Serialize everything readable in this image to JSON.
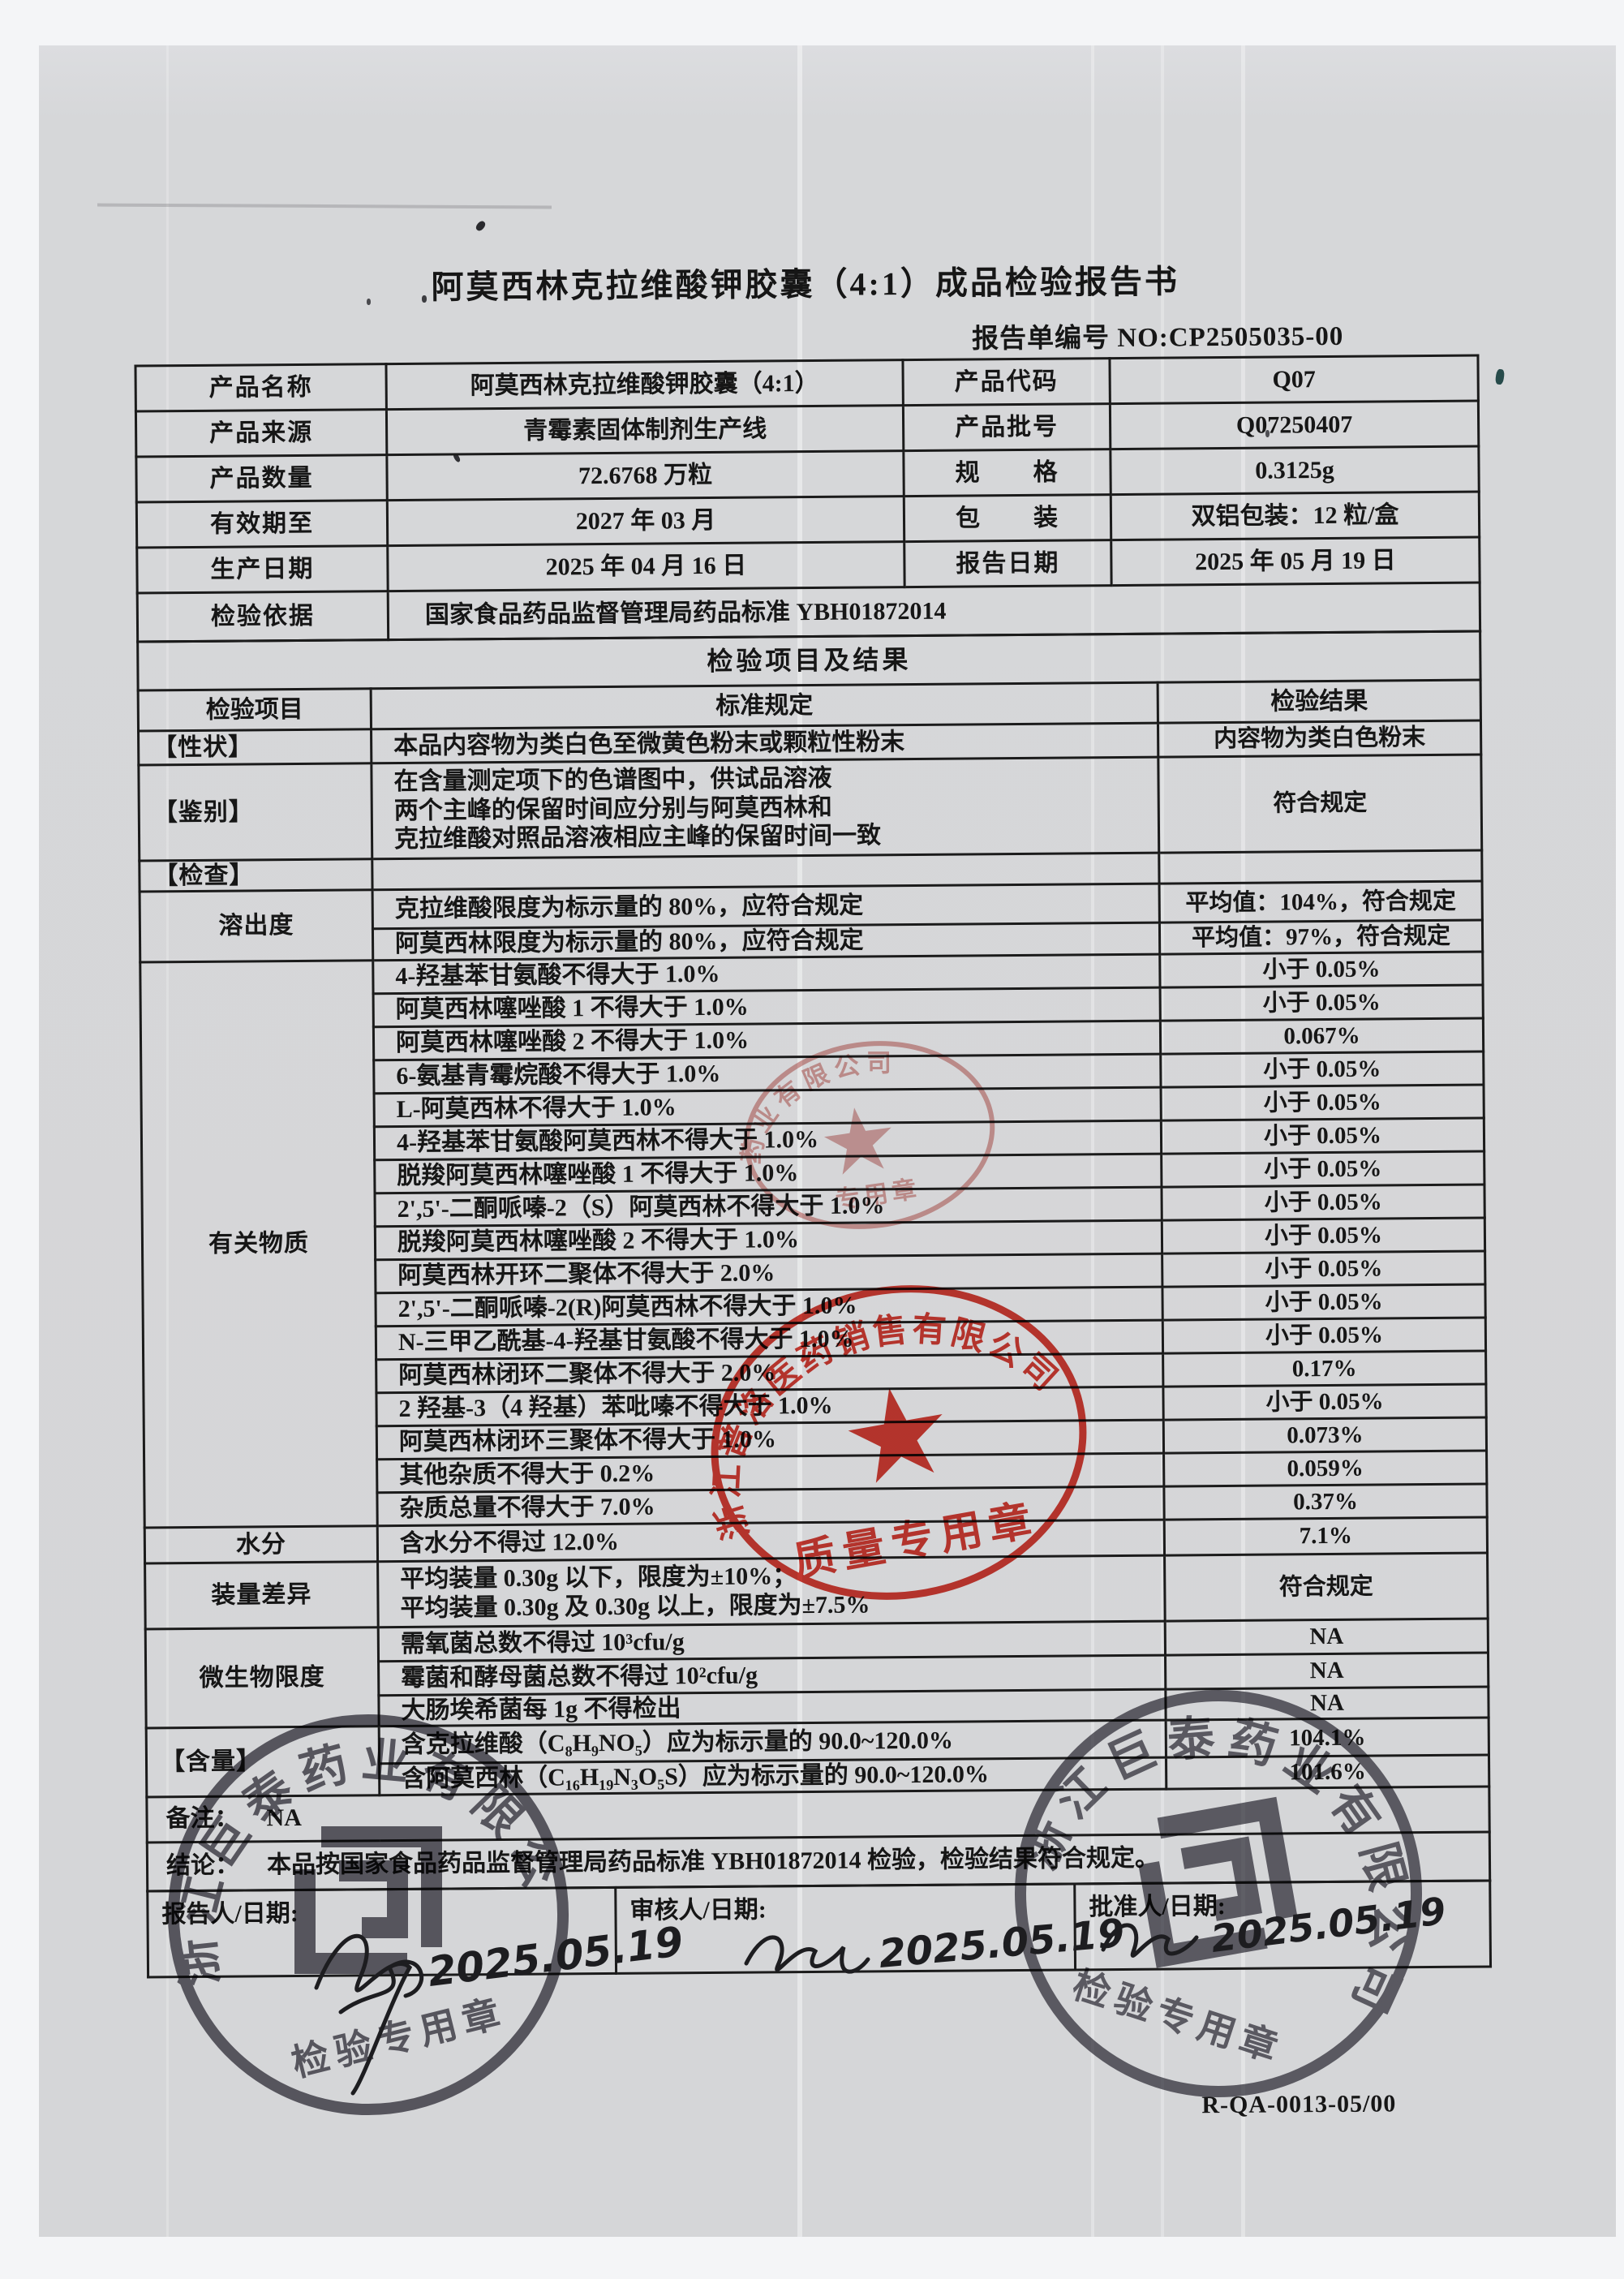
{
  "page": {
    "title": "阿莫西林克拉维酸钾胶囊（4:1）成品检验报告书",
    "report_no": "报告单编号 NO:CP2505035-00",
    "form_code": "R-QA-0013-05/00"
  },
  "info": {
    "rows": [
      {
        "l1": "产品名称",
        "v1": "阿莫西林克拉维酸钾胶囊（4:1）",
        "l2": "产品代码",
        "v2": "Q07"
      },
      {
        "l1": "产品来源",
        "v1": "青霉素固体制剂生产线",
        "l2": "产品批号",
        "v2": "Q07250407"
      },
      {
        "l1": "产品数量",
        "v1": "72.6768 万粒",
        "l2": "规　　格",
        "v2": "0.3125g"
      },
      {
        "l1": "有效期至",
        "v1": "2027 年 03 月",
        "l2": "包　　装",
        "v2": "双铝包装：12 粒/盒"
      },
      {
        "l1": "生产日期",
        "v1": "2025 年 04 月 16 日",
        "l2": "报告日期",
        "v2": "2025 年 05 月 19 日"
      }
    ],
    "basis_label": "检验依据",
    "basis_value": "国家食品药品监督管理局药品标准 YBH01872014"
  },
  "results": {
    "section_title": "检验项目及结果",
    "headers": [
      "检验项目",
      "标准规定",
      "检验结果"
    ],
    "groups": [
      {
        "item": "【性状】",
        "rows": [
          {
            "spec": "本品内容物为类白色至微黄色粉末或颗粒性粉末",
            "result": "内容物为类白色粉末",
            "h": 42
          }
        ]
      },
      {
        "item": "【鉴别】",
        "rows": [
          {
            "spec": "在含量测定项下的色谱图中，供试品溶液\n两个主峰的保留时间应分别与阿莫西林和\n克拉维酸对照品溶液相应主峰的保留时间一致",
            "result": "符合规定",
            "h": 118
          }
        ]
      },
      {
        "item": "【检查】",
        "rows": [
          {
            "spec": "",
            "result": "",
            "h": 37
          }
        ]
      },
      {
        "item": "溶出度",
        "rows": [
          {
            "spec": "克拉维酸限度为标示量的 80%，应符合规定",
            "result": "平均值：104%，符合规定",
            "h": 48
          },
          {
            "spec": "阿莫西林限度为标示量的 80%，应符合规定",
            "result": "平均值：97%，符合规定",
            "h": 38
          }
        ]
      },
      {
        "item": "有关物质",
        "rows": [
          {
            "spec": "4-羟基苯甘氨酸不得大于 1.0%",
            "result": "小于 0.05%",
            "h": 41
          },
          {
            "spec": "阿莫西林噻唑酸 1 不得大于 1.0%",
            "result": "小于 0.05%",
            "h": 41
          },
          {
            "spec": "阿莫西林噻唑酸 2 不得大于 1.0%",
            "result": "0.067%",
            "h": 41
          },
          {
            "spec": "6-氨基青霉烷酸不得大于 1.0%",
            "result": "小于 0.05%",
            "h": 41
          },
          {
            "spec": "L-阿莫西林不得大于 1.0%",
            "result": "小于 0.05%",
            "h": 41
          },
          {
            "spec": "4-羟基苯甘氨酸阿莫西林不得大于 1.0%",
            "result": "小于 0.05%",
            "h": 41
          },
          {
            "spec": "脱羧阿莫西林噻唑酸 1 不得大于 1.0%",
            "result": "小于 0.05%",
            "h": 41
          },
          {
            "spec": "2',5'-二酮哌嗪-2（S）阿莫西林不得大于 1.0%",
            "result": "小于 0.05%",
            "h": 41
          },
          {
            "spec": "脱羧阿莫西林噻唑酸 2 不得大于 1.0%",
            "result": "小于 0.05%",
            "h": 41
          },
          {
            "spec": "阿莫西林开环二聚体不得大于 2.0%",
            "result": "小于 0.05%",
            "h": 41
          },
          {
            "spec": "2',5'-二酮哌嗪-2(R)阿莫西林不得大于 1.0%",
            "result": "小于 0.05%",
            "h": 41
          },
          {
            "spec": "N-三甲乙酰基-4-羟基甘氨酸不得大于 1.0%",
            "result": "小于 0.05%",
            "h": 41
          },
          {
            "spec": "阿莫西林闭环二聚体不得大于 2.0%",
            "result": "0.17%",
            "h": 41
          },
          {
            "spec": "2 羟基-3（4 羟基）苯吡嗪不得大于 1.0%",
            "result": "小于 0.05%",
            "h": 41
          },
          {
            "spec": "阿莫西林闭环三聚体不得大于 1.0%",
            "result": "0.073%",
            "h": 41
          },
          {
            "spec": "其他杂质不得大于 0.2%",
            "result": "0.059%",
            "h": 41
          },
          {
            "spec": "杂质总量不得大于 7.0%",
            "result": "0.37%",
            "h": 41
          }
        ]
      },
      {
        "item": "水分",
        "rows": [
          {
            "spec": "含水分不得过 12.0%",
            "result": "7.1%",
            "h": 44
          }
        ]
      },
      {
        "item": "装量差异",
        "rows": [
          {
            "spec": "平均装量 0.30g 以下，限度为±10%；\n平均装量 0.30g 及 0.30g 以上，限度为±7.5%",
            "result": "符合规定",
            "h": 81
          }
        ]
      },
      {
        "item": "微生物限度",
        "rows": [
          {
            "spec": "需氧菌总数不得过 10³cfu/g",
            "result": "NA",
            "h": 42
          },
          {
            "spec": "霉菌和酵母菌总数不得过 10²cfu/g",
            "result": "NA",
            "h": 42
          },
          {
            "spec": "大肠埃希菌每 1g 不得检出",
            "result": "NA",
            "h": 37
          }
        ]
      },
      {
        "item": "【含量】",
        "rows": [
          {
            "spec": "含克拉维酸（C₈H₉NO₅）应为标示量的 90.0~120.0%",
            "result": "104.1%",
            "h": 46
          },
          {
            "spec": "含阿莫西林（C₁₆H₁₉N₃O₅S）应为标示量的 90.0~120.0%",
            "result": "101.6%",
            "h": 34
          }
        ]
      }
    ],
    "remark_label": "备注：",
    "remark_value": "NA",
    "conclusion_label": "结论：",
    "conclusion_value": "本品按国家食品药品监督管理局药品标准 YBH01872014 检验，检验结果符合规定。"
  },
  "signatures": {
    "cells": [
      {
        "label": "报告人/日期:",
        "date": "2025.05.19"
      },
      {
        "label": "审核人/日期:",
        "date": "2025.05.19"
      },
      {
        "label": "批准人/日期:",
        "date": "2025.05.19"
      }
    ]
  },
  "stamps": {
    "red_small": {
      "ring_text": "药业有限公司",
      "bottom_text": "专用章"
    },
    "red_large": {
      "ring_text": "浙江普洛医药销售有限公司",
      "bottom_text": "质量专用章"
    },
    "dark_left": {
      "ring_text": "浙江巨泰药业有限公司",
      "bottom_text": "检验专用章"
    },
    "dark_right": {
      "ring_text": "浙江巨泰药业有限公司",
      "bottom_text": "检验专用章"
    }
  }
}
